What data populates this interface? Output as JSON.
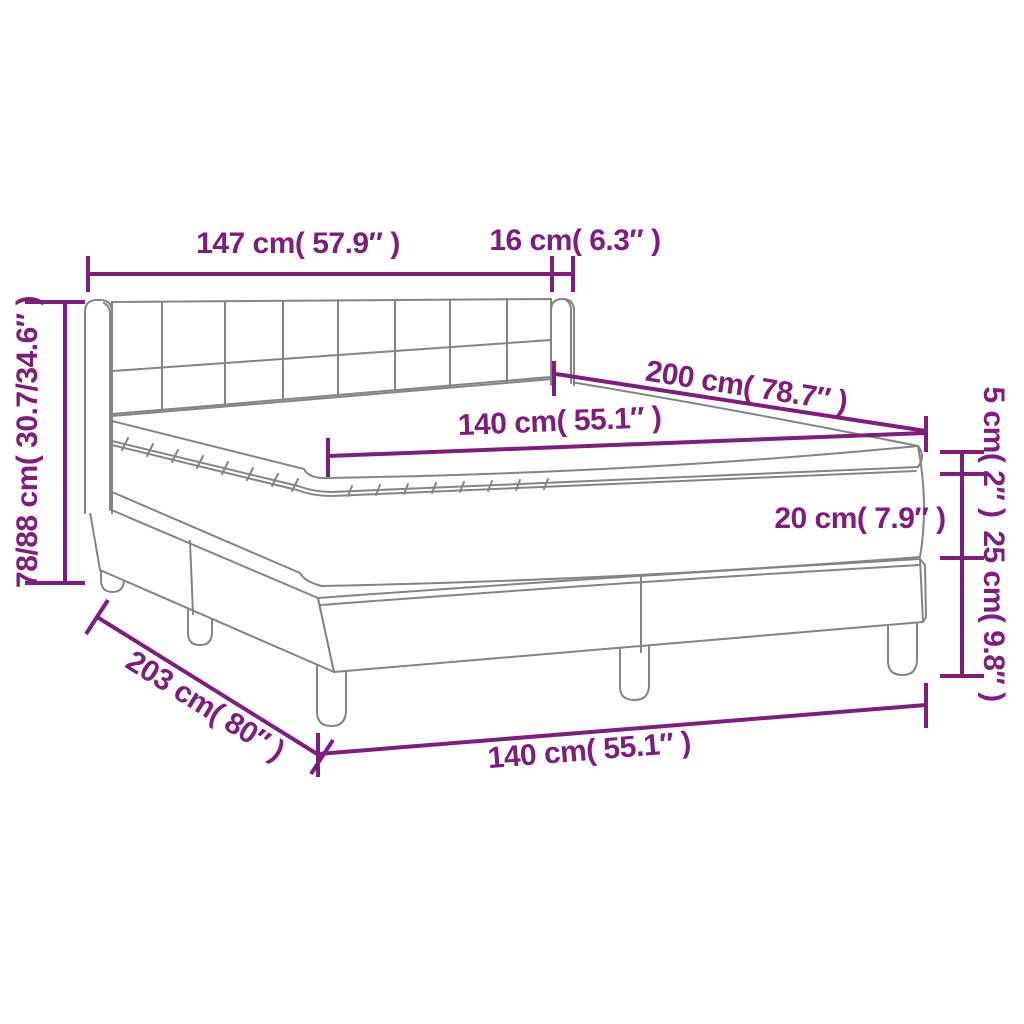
{
  "figure": {
    "subject": "box-spring-bed-with-headboard-mattress-and-topper",
    "style": "product-dimension-diagram"
  },
  "colors": {
    "accent": "#7E1D7C",
    "line_gray": "#848484",
    "background": "#FFFFFF"
  },
  "labels": {
    "headboard_width": "147 cm( 57.9″ )",
    "headboard_wing_depth": "16 cm( 6.3″ )",
    "overall_height": "78/88 cm( 30.7/34.6″ )",
    "mattress_length": "200 cm( 78.7″ )",
    "mattress_width": "140 cm( 55.1″ )",
    "topper_thickness": "5 cm( 2″ )",
    "mattress_thickness": "20 cm( 7.9″ )",
    "base_height": "25 cm( 9.8″ )",
    "overall_length": "203 cm( 80″ )",
    "base_width": "140 cm( 55.1″ )"
  }
}
